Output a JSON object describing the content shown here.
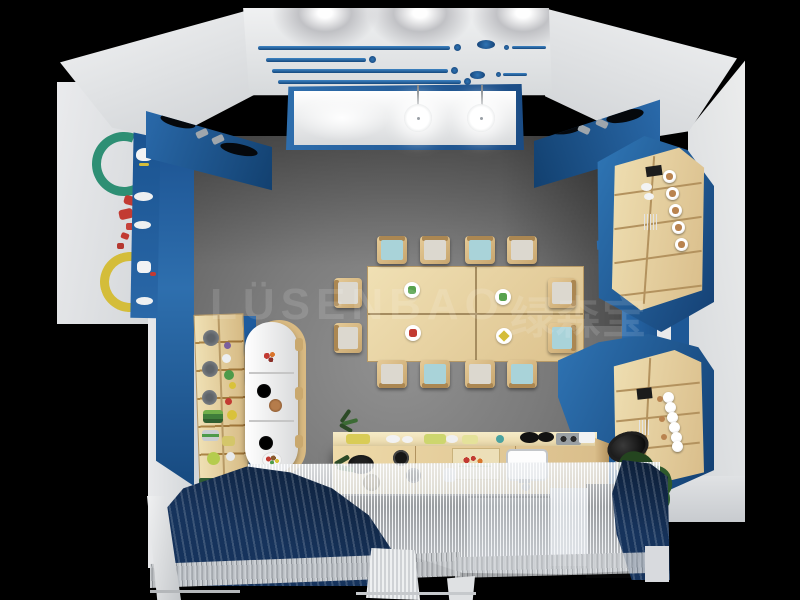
{
  "scene": {
    "description": "Top-down 3D interior render of a kindergarten dining room with blue and white walls, four wooden tables with twelve chairs, a play-kitchen counter, curved display cabinets, plate shelves and navy curtains",
    "watermark": {
      "latin": "LÜSENBAO",
      "cjk": "绿森宝",
      "full": "LÜSENBAO 绿森宝"
    },
    "room": {
      "tables": {
        "count": 4,
        "arrangement": "2x2",
        "plate_stickers": [
          "green",
          "green",
          "red",
          "yellow"
        ]
      },
      "chairs": {
        "count": 12,
        "top_row": [
          "blue",
          "gray",
          "blue",
          "gray"
        ],
        "bottom_row": [
          "gray",
          "blue",
          "gray",
          "blue"
        ],
        "left_side": [
          "gray",
          "gray"
        ],
        "right_side": [
          "gray",
          "blue"
        ]
      },
      "objects": [
        "ceiling-stripe-panel",
        "recessed-lightbox",
        "pendant-lights",
        "blue-soffit-cutouts",
        "green-wreath",
        "yellow-wreath",
        "red-wall-decor",
        "wall-shelf-strip",
        "jar-shelf",
        "capsule-cabinet",
        "play-kitchen-counter",
        "plate-shelf-upper",
        "plate-shelf-lower",
        "potted-plant",
        "navy-curtain-left",
        "navy-curtain-right",
        "sheer-curtain",
        "book-stack"
      ]
    },
    "palette": {
      "background": "#000000",
      "wall_blue": "#2a6aab",
      "wall_blue_dark": "#143f72",
      "ceiling_white": "#e9eaec",
      "floor_gray": "#7b7b7b",
      "wood_light": "#ecd9ab",
      "wood_dark": "#c9ab74",
      "chair_blue": "#a9d3d9",
      "chair_gray": "#dcd8cf",
      "curtain_navy": "#16335c",
      "sheer_gray": "#d0d6dc",
      "plant_green": "#2f5a2c",
      "decor_green": "#2e8f74",
      "decor_yellow": "#d4bd3a",
      "decor_red": "#c23a32"
    }
  }
}
